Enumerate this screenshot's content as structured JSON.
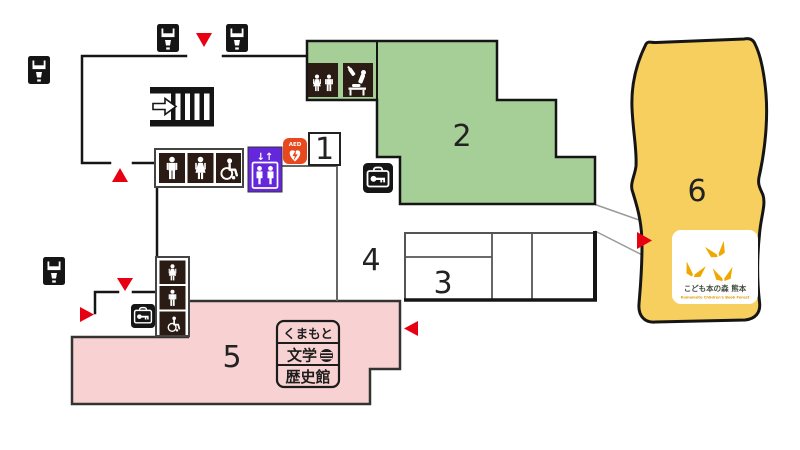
{
  "map_title": "facility-floor-map",
  "colors": {
    "green_area": "#a6ce97",
    "pink_area": "#f8d2d2",
    "yellow_area": "#f7cf5e",
    "purple_elevator": "#6527db",
    "aed_orange": "#e8481e",
    "marker_red": "#e60012",
    "icon_dark": "#2a1b14",
    "wall_black": "#151515",
    "wall_gray": "#666666",
    "bridge_gray": "#999999"
  },
  "areas": {
    "area1": {
      "label": "1"
    },
    "area2": {
      "label": "2"
    },
    "area3": {
      "label": "3"
    },
    "area4": {
      "label": "4"
    },
    "area5": {
      "label": "5"
    },
    "area6": {
      "label": "6"
    }
  },
  "elevator": {
    "arrows": "↓↑"
  },
  "aed": {
    "label": "AED"
  },
  "museum_stamp": {
    "line1": "くまもと",
    "line2": "文学",
    "line3": "歴史館"
  },
  "book_forest": {
    "name_jp": "こども本の森 熊本",
    "name_en": "Kumamoto Children's Book Forest"
  },
  "facility_icons": {
    "vending_machine": "drink-vending-machine",
    "stairs": "stairs-with-right-arrow",
    "mens_toilet": "man-figure",
    "womens_toilet": "woman-figure",
    "accessible_toilet": "wheelchair-figure",
    "family_toilet": "adult-and-child-figures",
    "baby_room": "baby-bottle-and-changing-table",
    "elevator": "elevator-car-with-people",
    "aed": "heart-with-lightning-bolt",
    "cloakroom_key": "bag-with-key",
    "entrance_marker": "red-triangle"
  }
}
